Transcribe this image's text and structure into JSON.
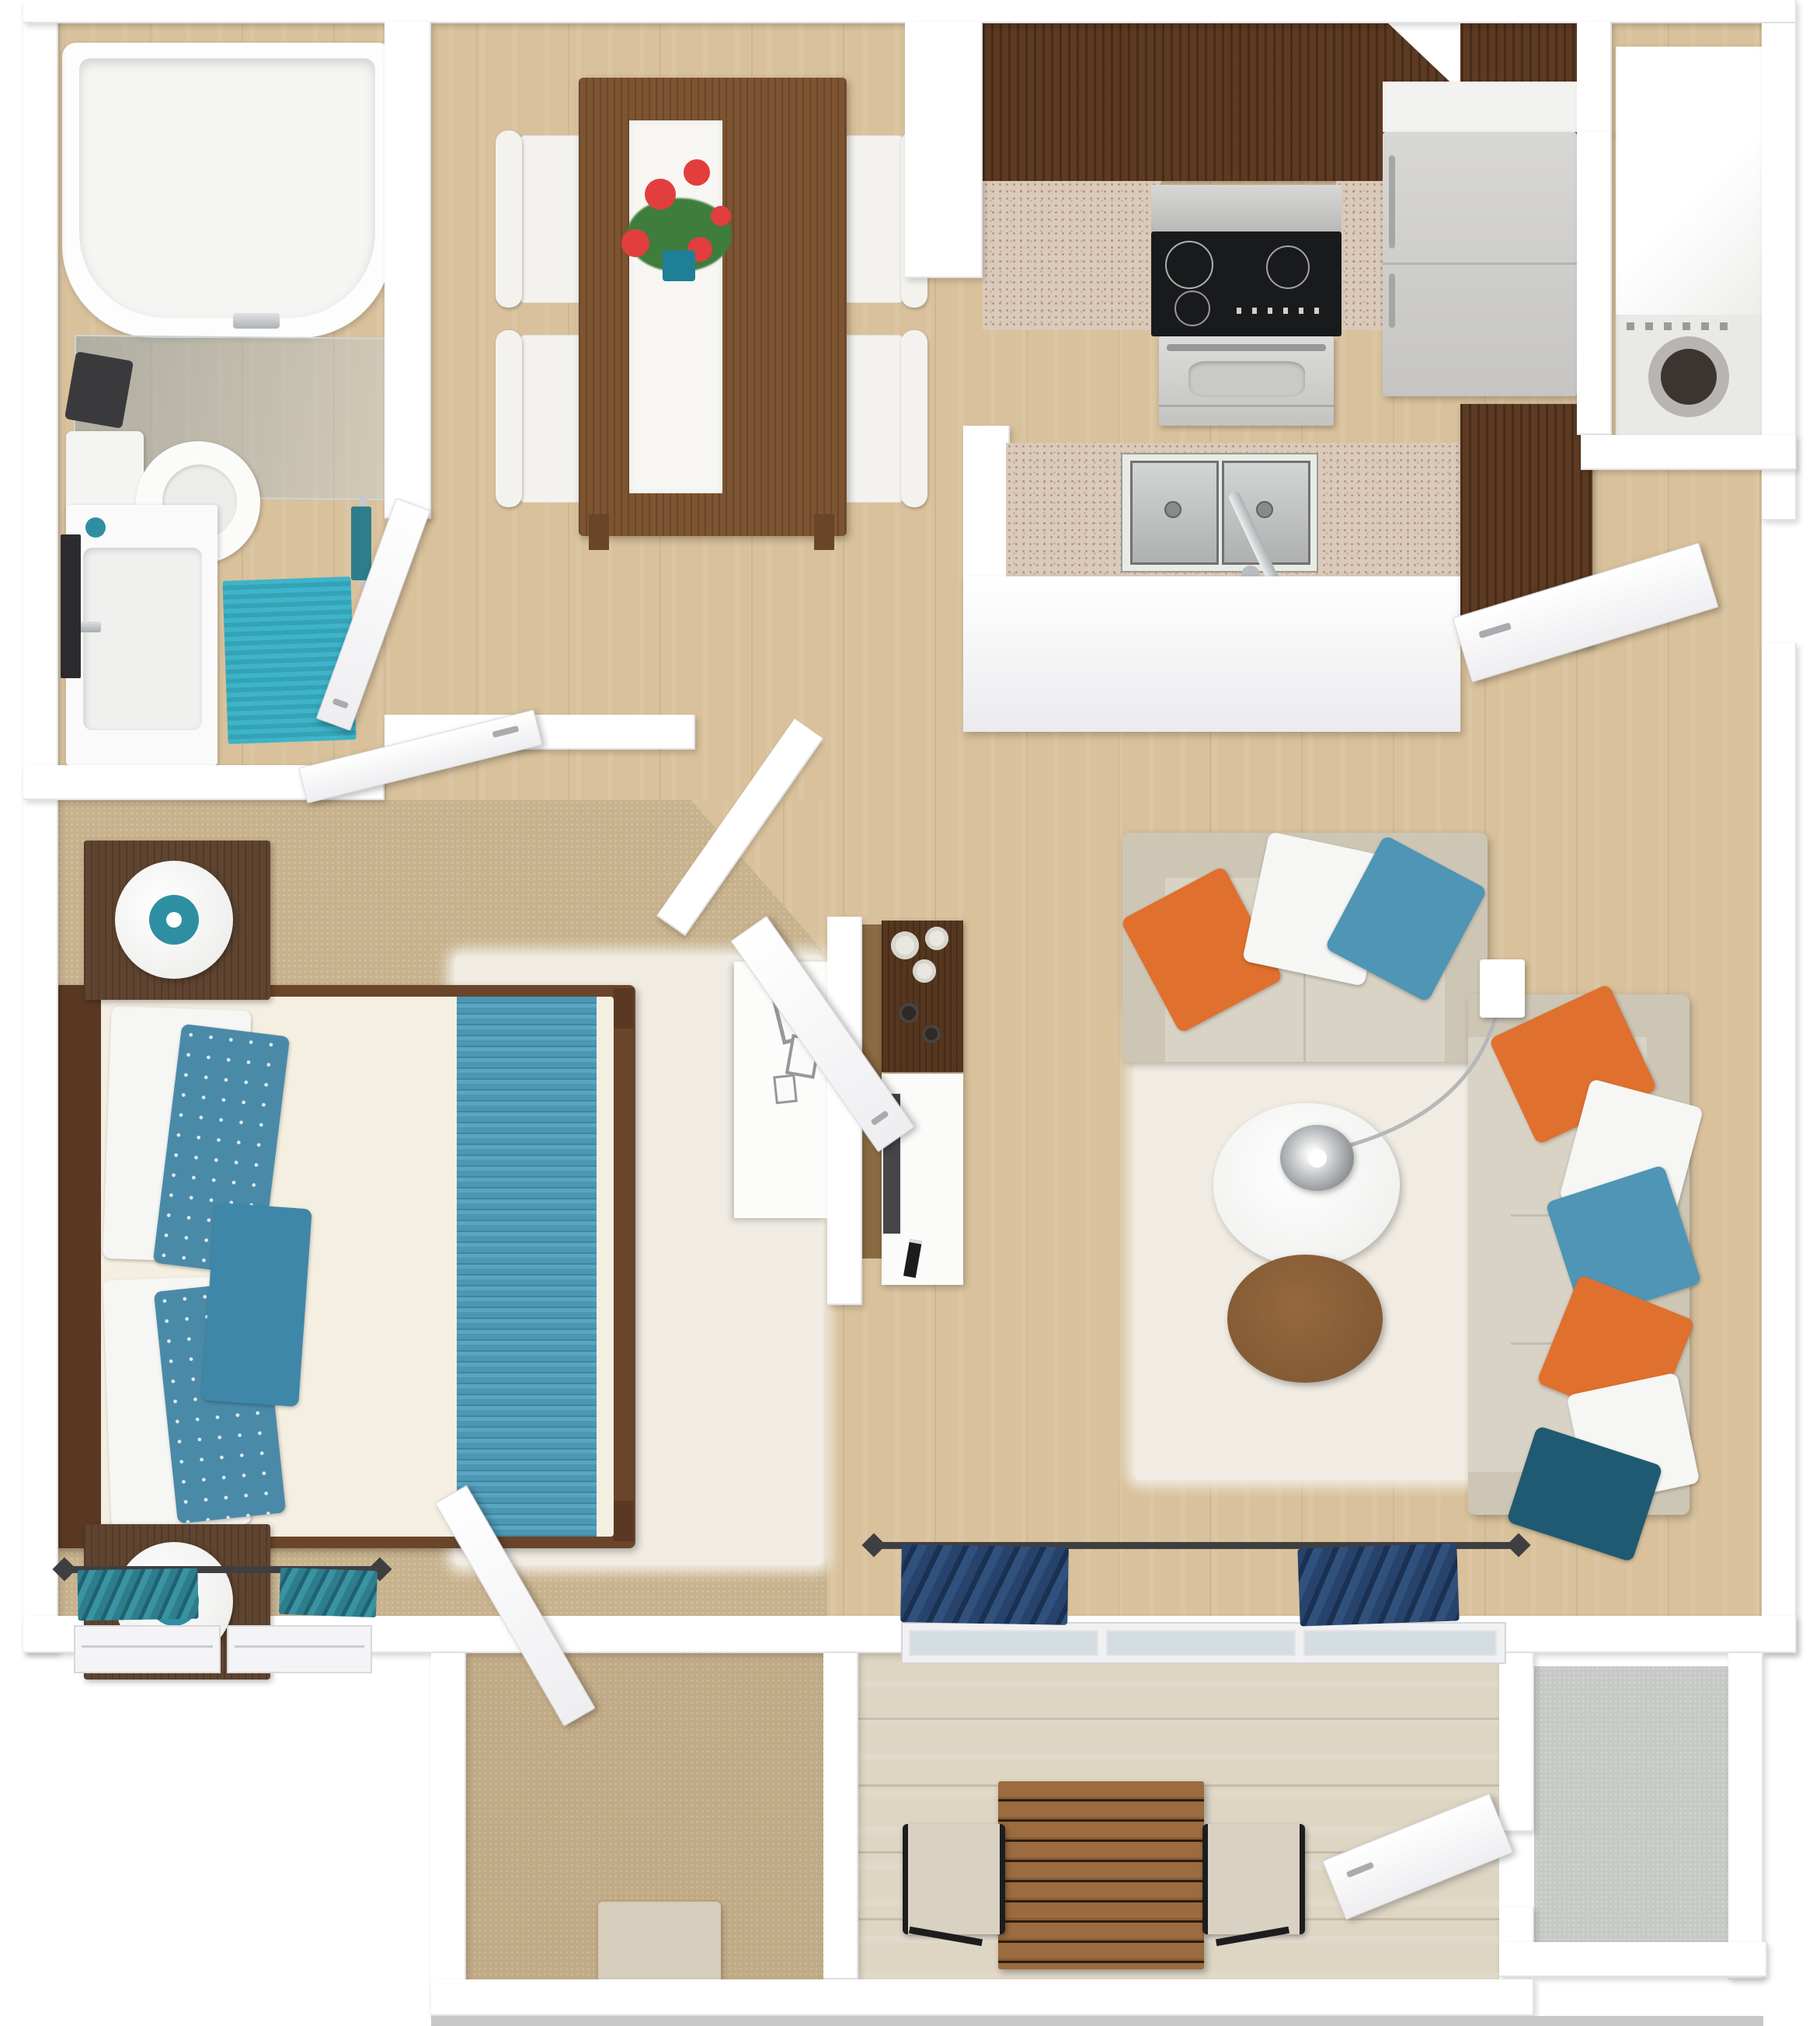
{
  "title": "3D top-down floor plan — one-bedroom apartment",
  "plan": {
    "type": "3d-rendered floor plan",
    "view": "top-down",
    "rooms": [
      {
        "name": "bathroom",
        "floor": "light wood",
        "furniture": [
          "bathtub with glass screen",
          "toilet",
          "vanity sink",
          "teal bath mat",
          "towel rail",
          "mirror"
        ]
      },
      {
        "name": "dining-area",
        "floor": "light wood",
        "furniture": [
          "wood dining table",
          "white table runner",
          "red flower centerpiece in teal pot",
          "4 white chairs"
        ]
      },
      {
        "name": "kitchen",
        "floor": "light wood",
        "furniture": [
          "dark wood upper cabinets",
          "granite counters",
          "cooktop with oven",
          "refrigerator",
          "double-basin sink peninsula",
          "dark wood pantry cabinet"
        ]
      },
      {
        "name": "laundry-nook",
        "floor": "light wood",
        "furniture": [
          "front-load washer"
        ]
      },
      {
        "name": "bedroom",
        "floor": "tan carpet",
        "furniture": [
          "queen bed with blue striped runner",
          "white and blue floral pillows",
          "2 nightstands",
          "2 round white lamps",
          "white shag rug",
          "white dresser with picture frames",
          "teal window curtains"
        ]
      },
      {
        "name": "living-room",
        "floor": "light wood",
        "furniture": [
          "beige sectional loveseat",
          "beige sofa",
          "orange blue and white throw pillows",
          "white round coffee table",
          "round wood side table",
          "chrome arc floor lamp",
          "white shag rug",
          "navy curtains",
          "sliding glass door"
        ]
      },
      {
        "name": "hallway",
        "floor": "light wood",
        "furniture": [
          "wall console with vases",
          "white tv bench",
          "flat tv",
          "remote"
        ]
      },
      {
        "name": "walk-in-closet",
        "floor": "tan carpet",
        "furniture": [
          "beige ottoman"
        ]
      },
      {
        "name": "patio",
        "floor": "whitewashed planks",
        "furniture": [
          "slatted wood table",
          "2 sling chairs"
        ]
      },
      {
        "name": "outdoor-storage",
        "floor": "gray concrete",
        "furniture": []
      }
    ],
    "doors": [
      "bathroom door",
      "bedroom hall door",
      "bedroom side door",
      "entry door",
      "closet door",
      "patio storage door"
    ]
  },
  "colors": {
    "wall": "#ffffff",
    "wall_edge": "#e3e3e6",
    "wood": "#d8c19b",
    "carpet": "#c8b28d",
    "carpet_closet": "#c1aa86",
    "patio_wood": "#ded5c3",
    "storage_floor": "#c6c9c6",
    "cabinet": "#5d3a22",
    "granite": "#dbcaba",
    "steel": "#c9c9c7",
    "black_appliance": "#191a1c",
    "fridge": "#d8d7d5",
    "sofa": "#d9d3c5",
    "sofa_dark": "#cdc6b5",
    "pillow_orange": "#e0702e",
    "pillow_blue": "#4f95b5",
    "pillow_white": "#f6f6f4",
    "pillow_teal": "#1f5a72",
    "bed_frame": "#6a452a",
    "headboard": "#5a3823",
    "mattress": "#f5efe1",
    "runner": "#4b97b4",
    "floral": "#4a8aa8",
    "rug_shag": "#f1ece3",
    "rug_teal": "#3db4c9",
    "curtain_teal": "#2e7d8c",
    "curtain_navy": "#27436b",
    "dining_table": "#7d5431",
    "chair": "#f3f2ef",
    "lamp_teal": "#2e8fa3",
    "door": "#ffffff",
    "tv_dark": "#46464a",
    "console_brown": "#55361f",
    "side_panel": "#8a6a42",
    "patio_table": "#9c6b3f",
    "ottoman": "#d6cdbc",
    "rod": "#3f3f42",
    "flower_red": "#e23e3e",
    "leaf_green": "#3e7d3c",
    "pot_teal": "#1f7f96",
    "outside_strip": "#c7c7c7"
  }
}
